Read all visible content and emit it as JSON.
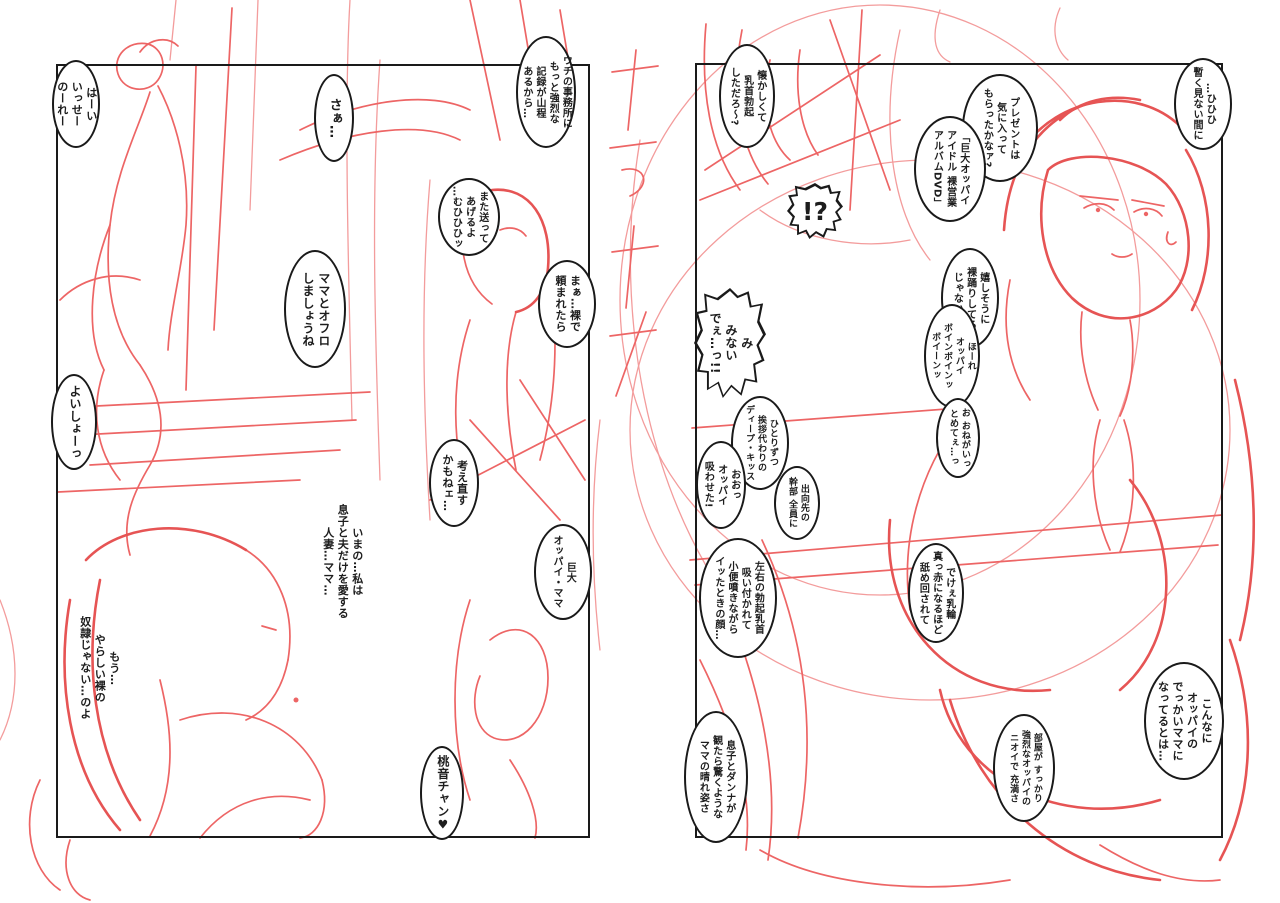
{
  "meta": {
    "paper_color": "#ffffff",
    "sketch_color": "#ed6565",
    "sketch_light_color": "#f39c9c",
    "ink_color": "#1a1a1a"
  },
  "pages": {
    "left": {
      "panel": {
        "x": 56,
        "y": 64,
        "w": 534,
        "h": 774
      },
      "bubbles": [
        {
          "name": "greeting",
          "shape": "ellipse",
          "x": 52,
          "y": 60,
          "w": 48,
          "h": 88,
          "fs": 11,
          "text": "はーい\nいっせー\nのーれー"
        },
        {
          "name": "saa",
          "shape": "ellipse",
          "x": 314,
          "y": 74,
          "w": 40,
          "h": 88,
          "fs": 13,
          "text": "さぁ…"
        },
        {
          "name": "office-records",
          "shape": "ellipse",
          "x": 516,
          "y": 36,
          "w": 60,
          "h": 112,
          "fs": 10,
          "text": "ウチの事務所に\nもっと強烈な\n記録が山程\nあるから…"
        },
        {
          "name": "send-again",
          "shape": "ellipse",
          "x": 438,
          "y": 178,
          "w": 62,
          "h": 78,
          "fs": 10,
          "text": "また送って\nあげるよ\n…むひひひッ"
        },
        {
          "name": "asked-naked",
          "shape": "ellipse",
          "x": 538,
          "y": 260,
          "w": 58,
          "h": 88,
          "fs": 11,
          "text": "まぁ…裸で\n頼まれたら"
        },
        {
          "name": "ofuro",
          "shape": "ellipse",
          "x": 284,
          "y": 250,
          "w": 62,
          "h": 118,
          "fs": 12,
          "text": "ママとオフロ\nしましょうね"
        },
        {
          "name": "yoisho",
          "shape": "ellipse",
          "x": 51,
          "y": 374,
          "w": 46,
          "h": 96,
          "fs": 12,
          "text": "よいしょーっ"
        },
        {
          "name": "reconsider",
          "shape": "ellipse",
          "x": 429,
          "y": 439,
          "w": 50,
          "h": 88,
          "fs": 11,
          "text": "考え直す\nかもねェ…"
        },
        {
          "name": "kyodai-oppai-mama",
          "shape": "ellipse",
          "x": 534,
          "y": 524,
          "w": 58,
          "h": 96,
          "fs": 10,
          "text": "巨大\nオッパイ・ママ"
        },
        {
          "name": "monologue-wife",
          "shape": "plain",
          "x": 316,
          "y": 490,
          "w": 52,
          "h": 142,
          "fs": 11,
          "text": "いまの…私は\n息子と夫だけを愛する\n人妻…ママ…"
        },
        {
          "name": "monologue-slave",
          "shape": "plain",
          "x": 73,
          "y": 606,
          "w": 52,
          "h": 124,
          "fs": 11,
          "text": "もう…\nやらしい裸の\n奴隷じゃない…のよ"
        },
        {
          "name": "momone-chan",
          "shape": "ellipse",
          "x": 420,
          "y": 746,
          "w": 44,
          "h": 94,
          "fs": 12,
          "text": "桃音チャン♥"
        }
      ]
    },
    "right": {
      "panel": {
        "x": 695,
        "y": 63,
        "w": 528,
        "h": 775
      },
      "bubbles": [
        {
          "name": "natsukashii",
          "shape": "ellipse",
          "x": 719,
          "y": 44,
          "w": 56,
          "h": 104,
          "fs": 10,
          "text": "懐かしくて\n乳首勃起\nしただろ〜?"
        },
        {
          "name": "present",
          "shape": "ellipse",
          "x": 962,
          "y": 74,
          "w": 76,
          "h": 108,
          "fs": 10,
          "text": "プレゼントは\n気に入って\nもらったかなァ?"
        },
        {
          "name": "dvd-title",
          "shape": "ellipse",
          "x": 914,
          "y": 116,
          "w": 72,
          "h": 106,
          "fs": 10,
          "text": "「巨大オッパイ\nアイドル 裸営業\nアルバムDVD」"
        },
        {
          "name": "hihihi",
          "shape": "ellipse",
          "x": 1174,
          "y": 58,
          "w": 58,
          "h": 92,
          "fs": 10,
          "text": "…ひひひ\n暫く見ない間に"
        },
        {
          "name": "exclaim",
          "shape": "burst-h",
          "x": 787,
          "y": 183,
          "w": 56,
          "h": 56,
          "fs": 25,
          "text": "!?"
        },
        {
          "name": "ureshisou",
          "shape": "ellipse",
          "x": 941,
          "y": 248,
          "w": 58,
          "h": 100,
          "fs": 10,
          "text": "嬉しそうに\n裸踊りしてる\nじゃないか"
        },
        {
          "name": "boin-boin",
          "shape": "ellipse",
          "x": 924,
          "y": 304,
          "w": 56,
          "h": 104,
          "fs": 9,
          "text": "ほーれ\nオッパイ\nボインボインッ\nボイーンッ"
        },
        {
          "name": "minai",
          "shape": "burst",
          "x": 694,
          "y": 288,
          "w": 72,
          "h": 110,
          "fs": 12,
          "text": "み\nみない\nでぇ…っ!!"
        },
        {
          "name": "onegai-tomete",
          "shape": "ellipse",
          "x": 936,
          "y": 398,
          "w": 44,
          "h": 80,
          "fs": 9,
          "text": "お おねがいっ\nとめてぇ…っ"
        },
        {
          "name": "hitorizutsu-kiss",
          "shape": "ellipse",
          "x": 731,
          "y": 396,
          "w": 58,
          "h": 94,
          "fs": 9,
          "text": "ひとりずつ\n挨拶代わりの\nディープ・キッス"
        },
        {
          "name": "oppai-suwaseta",
          "shape": "ellipse",
          "x": 696,
          "y": 441,
          "w": 50,
          "h": 88,
          "fs": 10,
          "text": "おおっ\nオッパイ\n吸わせた!"
        },
        {
          "name": "shukko-kanbu",
          "shape": "ellipse",
          "x": 774,
          "y": 466,
          "w": 46,
          "h": 74,
          "fs": 9,
          "text": "出向先の\n幹部 全員に"
        },
        {
          "name": "sayuu-chikubi",
          "shape": "ellipse",
          "x": 699,
          "y": 538,
          "w": 78,
          "h": 120,
          "fs": 10,
          "text": "左右の勃起乳首\n吸い付かれて\n小便噴きながら\nイッたときの顔…"
        },
        {
          "name": "dekee-nyurin",
          "shape": "ellipse",
          "x": 908,
          "y": 543,
          "w": 56,
          "h": 100,
          "fs": 10,
          "text": "でけぇ乳輪\n真っ赤になるほど\n舐め回されて"
        },
        {
          "name": "konna-ni-mama",
          "shape": "ellipse",
          "x": 1144,
          "y": 662,
          "w": 80,
          "h": 118,
          "fs": 11,
          "text": "こんなに\nオッパイの\nでっかいママに\nなってるとは…"
        },
        {
          "name": "heya-nioi",
          "shape": "ellipse",
          "x": 993,
          "y": 714,
          "w": 62,
          "h": 108,
          "fs": 9,
          "text": "部屋が すっかり\n強烈なオッパイの\nニオイで 充満さ"
        },
        {
          "name": "musuko-danna",
          "shape": "ellipse",
          "x": 684,
          "y": 711,
          "w": 64,
          "h": 132,
          "fs": 10,
          "text": "息子とダンナが\n観たら驚くような\nママの晴れ姿さ"
        }
      ]
    }
  }
}
